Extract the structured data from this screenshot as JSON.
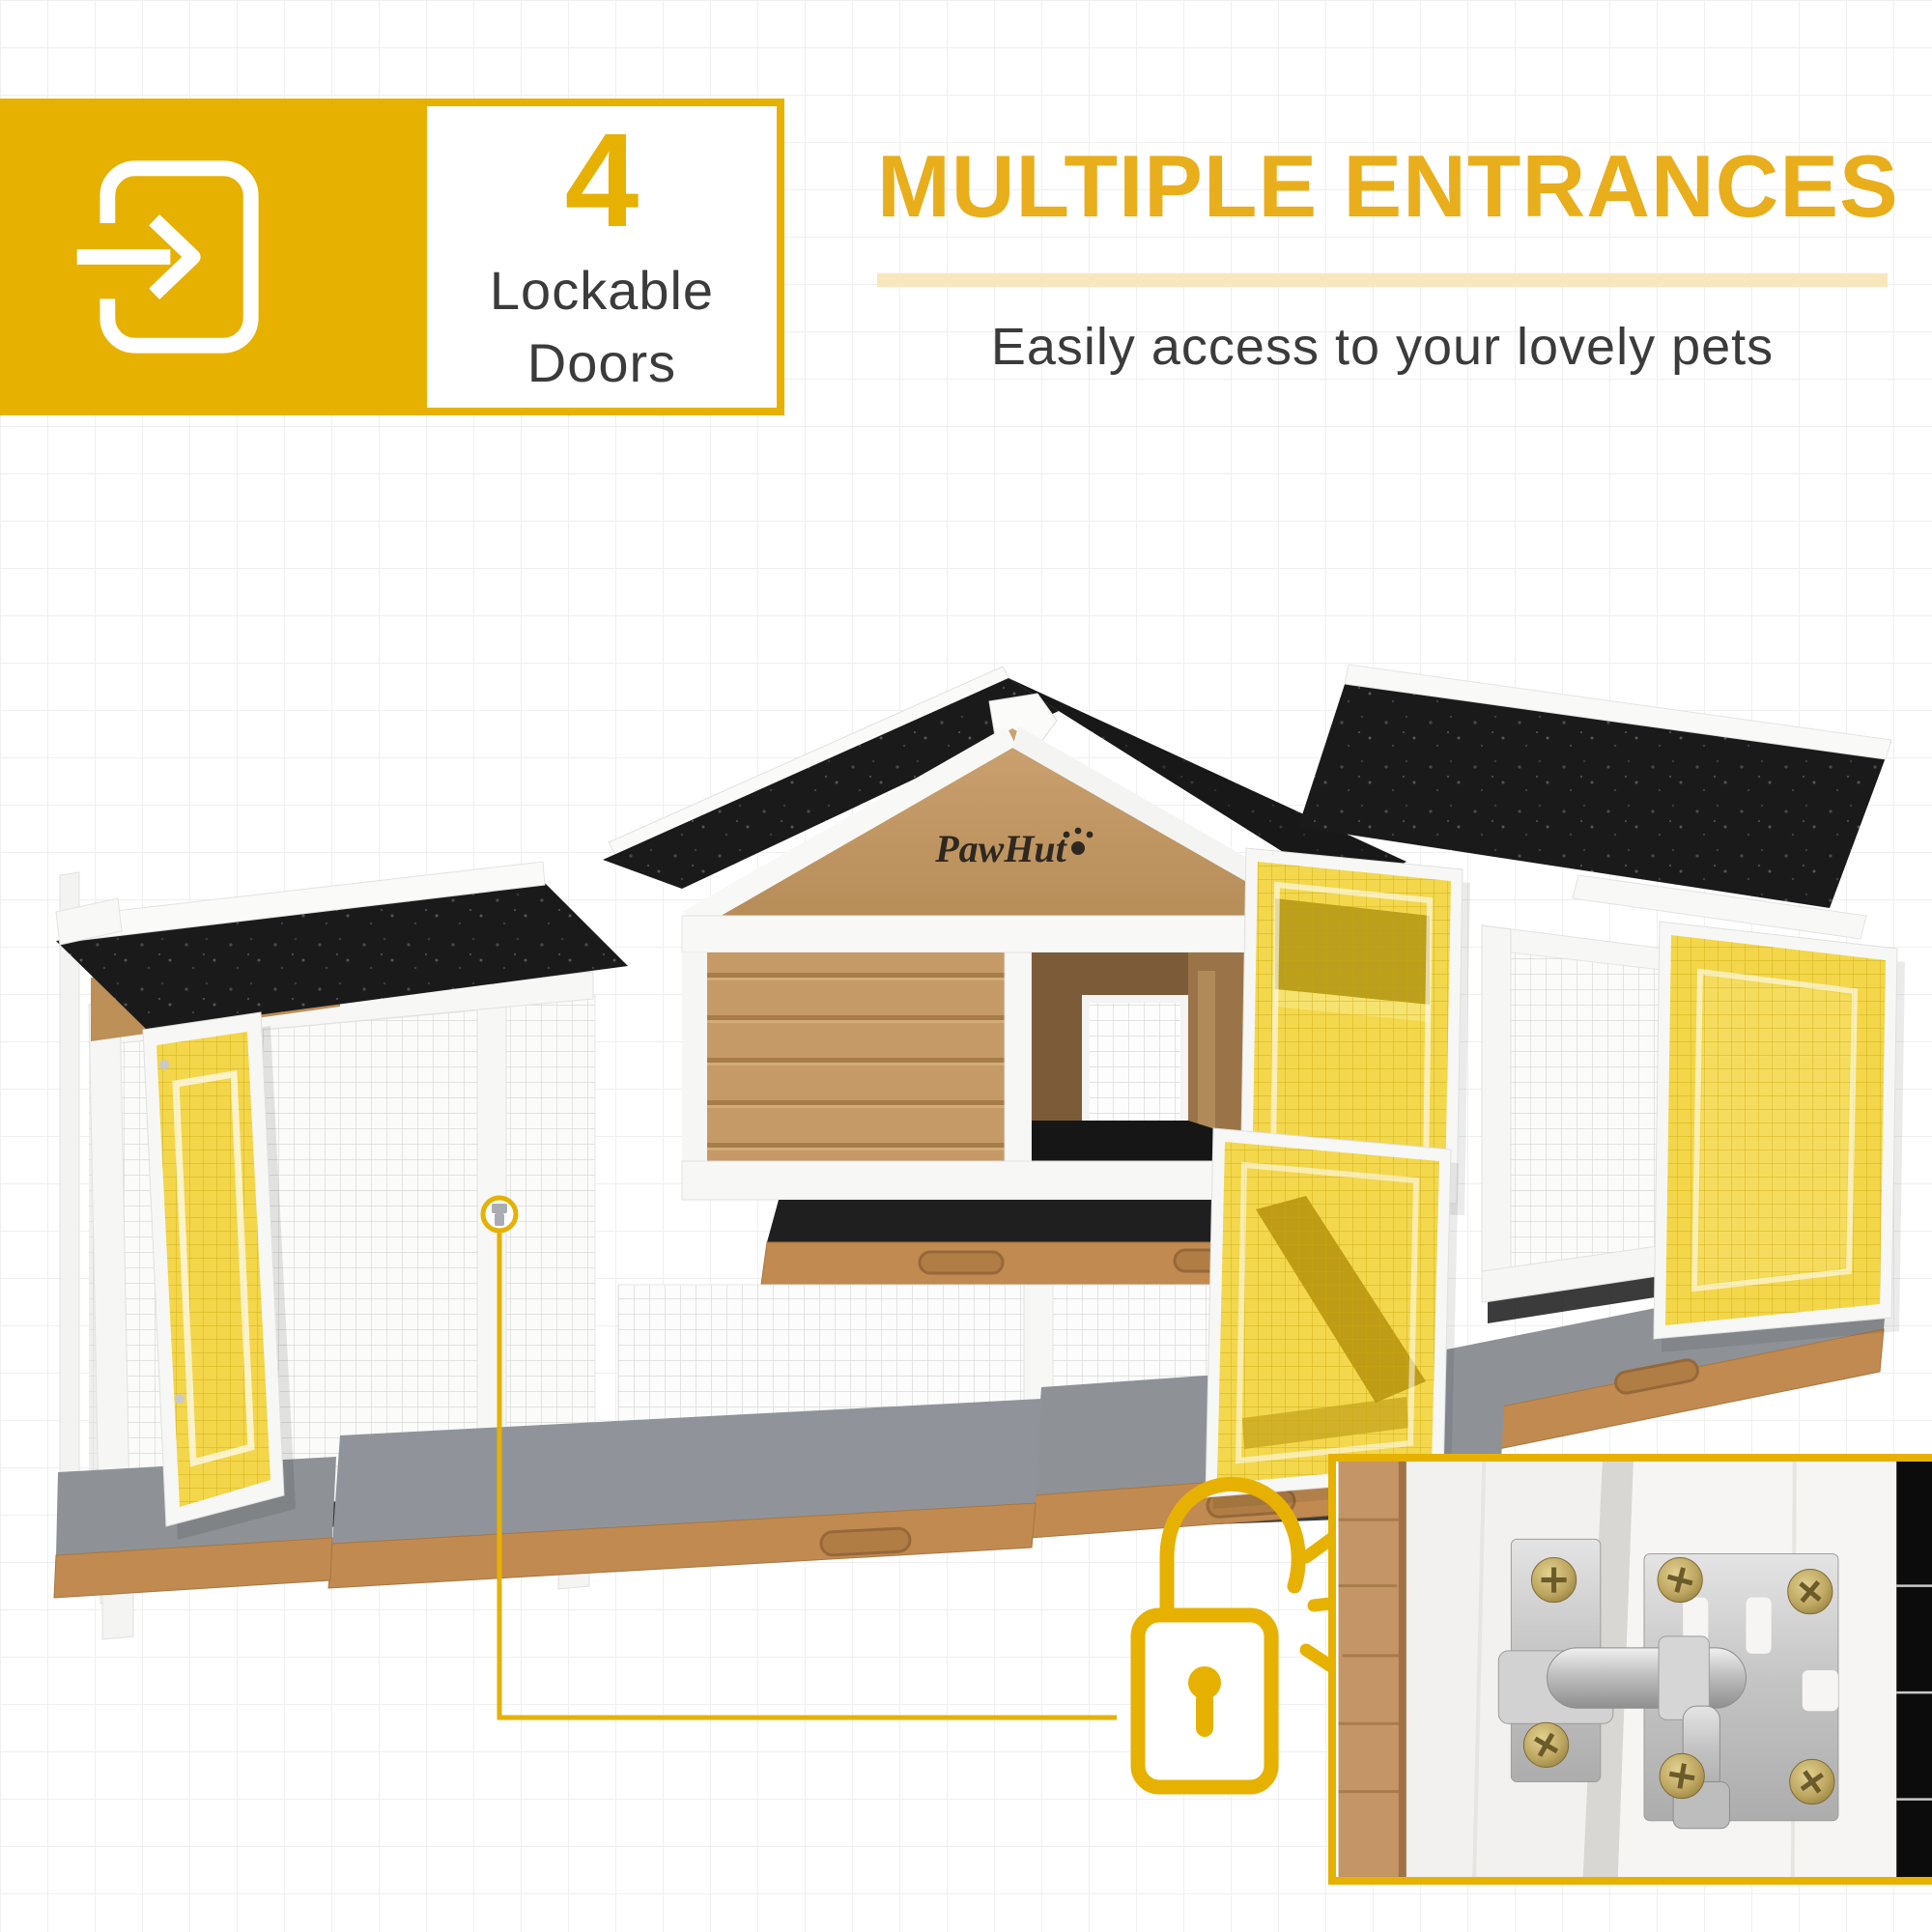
{
  "badge": {
    "icon": "enter-door-icon",
    "tile_color": "#E6B101",
    "count": "4",
    "label_line1": "Lockable",
    "label_line2": "Doors"
  },
  "headline": {
    "title": "MULTIPLE ENTRANCES",
    "title_color": "#E9AE1C",
    "divider_color": "#F8E7BD",
    "subtitle": "Easily access to your lovely pets",
    "subtitle_color": "#3B3B3B"
  },
  "product": {
    "brand": "PawHut",
    "subject": "wooden pet hutch with runs, gable asphalt roofs and wire mesh doors",
    "highlighted_doors": 4,
    "colors": {
      "highlight_door": "#F2D440",
      "roof": "#1A1A1A",
      "wood": "#C59A66",
      "frame": "#F7F7F6",
      "tray_felt": "#8E9296",
      "tray_wood": "#C08A50"
    }
  },
  "callout": {
    "icon": "padlock-icon",
    "accent_color": "#E6B101",
    "target": "door-latch",
    "extras": "lock-sound-lines"
  },
  "inset": {
    "name": "door-latch-closeup",
    "border_color": "#E6B101",
    "subject": "stainless barrel bolt latch with screws on white door frame"
  }
}
